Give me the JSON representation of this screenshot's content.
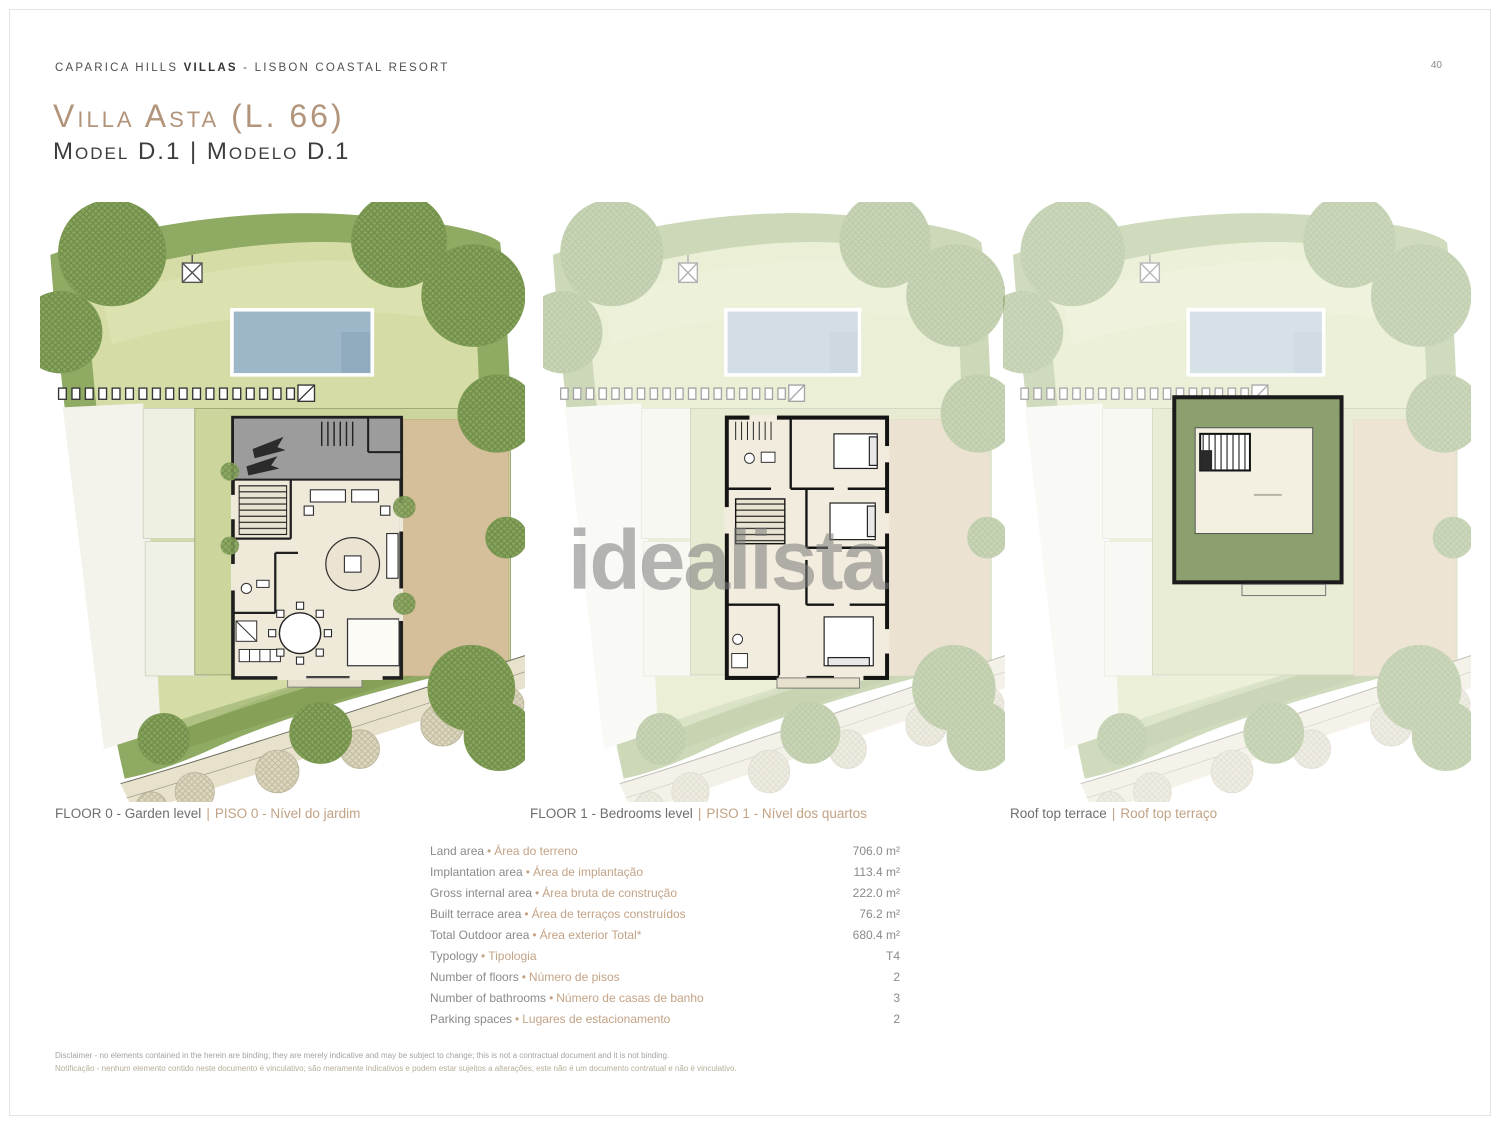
{
  "header": {
    "brand": {
      "prefix": "CAPARICA HILLS",
      "bold": "VILLAS",
      "separator": "-",
      "suffix": "LISBON COASTAL RESORT"
    },
    "page_number": "40"
  },
  "title": {
    "text": "Villa Asta (L. 66)",
    "model": "Model D.1  |  Modelo D.1"
  },
  "plans": [
    {
      "caption_en": "FLOOR 0 - Garden level",
      "caption_sep": "|",
      "caption_pt": "PISO 0 - Nível do jardim"
    },
    {
      "caption_en": "FLOOR 1 - Bedrooms level",
      "caption_sep": "|",
      "caption_pt": "PISO 1 - Nível dos quartos"
    },
    {
      "caption_en": "Roof top terrace",
      "caption_sep": "|",
      "caption_pt": "Roof top terraço"
    }
  ],
  "watermark": "idealista",
  "bullet": "•",
  "specs": [
    {
      "en": "Land area",
      "pt": "Área do terreno",
      "value": "706.0 m²"
    },
    {
      "en": "Implantation area",
      "pt": "Área de implantação",
      "value": "113.4 m²"
    },
    {
      "en": "Gross internal area",
      "pt": "Área bruta de construção",
      "value": "222.0 m²"
    },
    {
      "en": "Built terrace area",
      "pt": "Área de terraços construídos",
      "value": "76.2 m²"
    },
    {
      "en": "Total Outdoor area",
      "pt": "Área exterior Total*",
      "value": "680.4 m²"
    },
    {
      "en": "Typology",
      "pt": "Tipologia",
      "value": "T4"
    },
    {
      "en": "Number of floors",
      "pt": "Número de pisos",
      "value": "2"
    },
    {
      "en": "Number of bathrooms",
      "pt": "Número de casas de banho",
      "value": "3"
    },
    {
      "en": "Parking spaces",
      "pt": "Lugares de estacionamento",
      "value": "2"
    }
  ],
  "disclaimer": {
    "line1": "Disclaimer - no elements contained in the herein are binding; they are merely indicative and may be subject to change; this is not a contractual document and it is not binding.",
    "line2": "Notificação - nenhum elemento contido neste documento é vinculativo; são meramente indicativos e podem estar sujeitos a alterações; este não é um documento contratual e não é vinculativo."
  },
  "colors": {
    "title_tan": "#b2947a",
    "label_tan": "#c3a386",
    "text_gray": "#8a8a8a",
    "site_green": "#8faa62",
    "lawn_green": "#d5dca6",
    "pool_blue": "#9db6c8",
    "terrace_tan": "#d5bf9b"
  }
}
